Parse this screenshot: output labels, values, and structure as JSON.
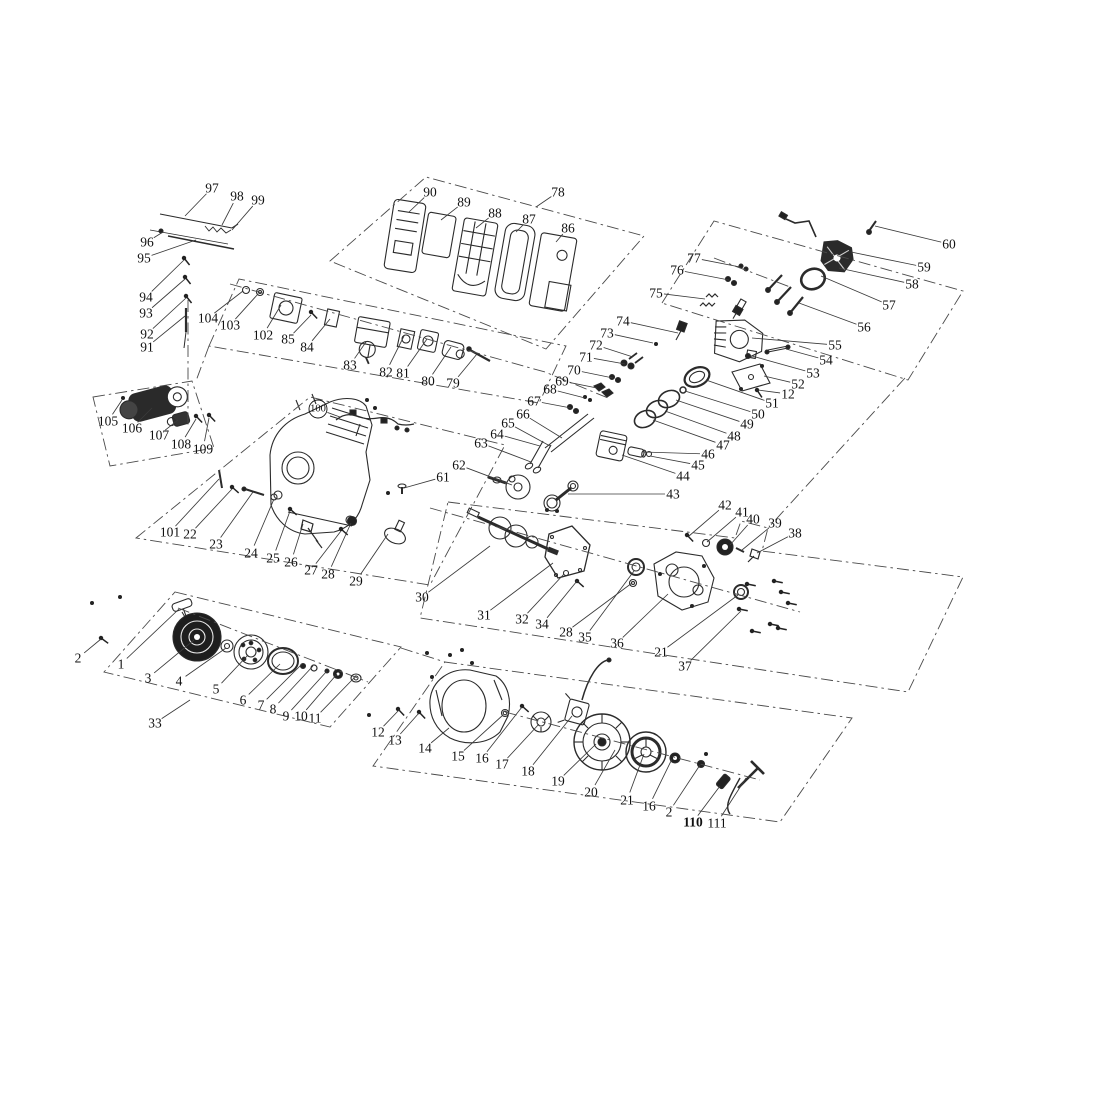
{
  "doc": {
    "kind": "engine exploded parts diagram",
    "page_background": "#ffffff"
  },
  "canvas": {
    "w": 1119,
    "h": 1119,
    "bg": "#ffffff",
    "ink": "#2b2b2b",
    "phantom_color": "#4a4a4a",
    "leader_color": "#3a3a3a",
    "label_color": "#111111",
    "label_font_size": 13.5
  },
  "callouts": [
    {
      "n": "97",
      "x": 212,
      "y": 188,
      "tx": 185,
      "ty": 216
    },
    {
      "n": "98",
      "x": 237,
      "y": 196,
      "tx": 222,
      "ty": 225
    },
    {
      "n": "99",
      "x": 258,
      "y": 200,
      "tx": 232,
      "ty": 230
    },
    {
      "n": "96",
      "x": 147,
      "y": 242,
      "tx": 163,
      "ty": 232
    },
    {
      "n": "95",
      "x": 144,
      "y": 258,
      "tx": 196,
      "ty": 240
    },
    {
      "n": "94",
      "x": 146,
      "y": 297,
      "tx": 184,
      "ty": 260
    },
    {
      "n": "93",
      "x": 146,
      "y": 313,
      "tx": 185,
      "ty": 279
    },
    {
      "n": "92",
      "x": 147,
      "y": 334,
      "tx": 186,
      "ty": 298
    },
    {
      "n": "91",
      "x": 147,
      "y": 347,
      "tx": 185,
      "ty": 316
    },
    {
      "n": "90",
      "x": 430,
      "y": 192,
      "tx": 409,
      "ty": 212
    },
    {
      "n": "89",
      "x": 464,
      "y": 202,
      "tx": 441,
      "ty": 220
    },
    {
      "n": "88",
      "x": 495,
      "y": 213,
      "tx": 476,
      "ty": 228
    },
    {
      "n": "87",
      "x": 529,
      "y": 219,
      "tx": 516,
      "ty": 232
    },
    {
      "n": "86",
      "x": 568,
      "y": 228,
      "tx": 556,
      "ty": 242
    },
    {
      "n": "78",
      "x": 558,
      "y": 192,
      "tx": 536,
      "ty": 207
    },
    {
      "n": "104",
      "x": 208,
      "y": 318,
      "tx": 243,
      "ty": 291
    },
    {
      "n": "103",
      "x": 230,
      "y": 325,
      "tx": 258,
      "ty": 294
    },
    {
      "n": "102",
      "x": 263,
      "y": 335,
      "tx": 281,
      "ty": 305
    },
    {
      "n": "85",
      "x": 288,
      "y": 339,
      "tx": 311,
      "ty": 315
    },
    {
      "n": "84",
      "x": 307,
      "y": 347,
      "tx": 330,
      "ty": 319
    },
    {
      "n": "83",
      "x": 350,
      "y": 365,
      "tx": 366,
      "ty": 342
    },
    {
      "n": "82",
      "x": 386,
      "y": 372,
      "tx": 404,
      "ty": 336
    },
    {
      "n": "81",
      "x": 403,
      "y": 373,
      "tx": 427,
      "ty": 339
    },
    {
      "n": "80",
      "x": 428,
      "y": 381,
      "tx": 451,
      "ty": 347
    },
    {
      "n": "79",
      "x": 453,
      "y": 383,
      "tx": 477,
      "ty": 354
    },
    {
      "n": "105",
      "x": 108,
      "y": 421,
      "tx": 122,
      "ty": 400
    },
    {
      "n": "106",
      "x": 132,
      "y": 428,
      "tx": 152,
      "ty": 408
    },
    {
      "n": "107",
      "x": 159,
      "y": 435,
      "tx": 178,
      "ty": 420
    },
    {
      "n": "108",
      "x": 181,
      "y": 444,
      "tx": 196,
      "ty": 419
    },
    {
      "n": "109",
      "x": 203,
      "y": 449,
      "tx": 209,
      "ty": 418
    },
    {
      "n": "100",
      "x": 318,
      "y": 409,
      "tx": 340,
      "ty": 417,
      "c": 1
    },
    {
      "n": "101",
      "x": 170,
      "y": 532,
      "tx": 219,
      "ty": 479
    },
    {
      "n": "22",
      "x": 190,
      "y": 534,
      "tx": 232,
      "ty": 489
    },
    {
      "n": "23",
      "x": 216,
      "y": 544,
      "tx": 253,
      "ty": 492
    },
    {
      "n": "24",
      "x": 251,
      "y": 553,
      "tx": 274,
      "ty": 499
    },
    {
      "n": "25",
      "x": 273,
      "y": 558,
      "tx": 290,
      "ty": 511
    },
    {
      "n": "26",
      "x": 291,
      "y": 562,
      "tx": 303,
      "ty": 524
    },
    {
      "n": "27",
      "x": 311,
      "y": 570,
      "tx": 341,
      "ty": 531
    },
    {
      "n": "28",
      "x": 328,
      "y": 574,
      "tx": 351,
      "ty": 523
    },
    {
      "n": "29",
      "x": 356,
      "y": 581,
      "tx": 388,
      "ty": 534
    },
    {
      "n": "61",
      "x": 443,
      "y": 477,
      "tx": 404,
      "ty": 488
    },
    {
      "n": "62",
      "x": 459,
      "y": 465,
      "tx": 512,
      "ty": 485
    },
    {
      "n": "63",
      "x": 481,
      "y": 443,
      "tx": 531,
      "ty": 462
    },
    {
      "n": "64",
      "x": 497,
      "y": 434,
      "tx": 540,
      "ty": 446
    },
    {
      "n": "65",
      "x": 508,
      "y": 423,
      "tx": 550,
      "ty": 446
    },
    {
      "n": "66",
      "x": 523,
      "y": 414,
      "tx": 562,
      "ty": 438
    },
    {
      "n": "67",
      "x": 534,
      "y": 401,
      "tx": 571,
      "ty": 408
    },
    {
      "n": "68",
      "x": 550,
      "y": 389,
      "tx": 585,
      "ty": 398
    },
    {
      "n": "69",
      "x": 562,
      "y": 381,
      "tx": 597,
      "ty": 388
    },
    {
      "n": "70",
      "x": 574,
      "y": 370,
      "tx": 613,
      "ty": 378
    },
    {
      "n": "71",
      "x": 586,
      "y": 357,
      "tx": 625,
      "ty": 364
    },
    {
      "n": "72",
      "x": 596,
      "y": 345,
      "tx": 633,
      "ty": 357
    },
    {
      "n": "73",
      "x": 607,
      "y": 333,
      "tx": 653,
      "ty": 343
    },
    {
      "n": "74",
      "x": 623,
      "y": 321,
      "tx": 678,
      "ty": 333
    },
    {
      "n": "75",
      "x": 656,
      "y": 293,
      "tx": 705,
      "ty": 299
    },
    {
      "n": "76",
      "x": 677,
      "y": 270,
      "tx": 729,
      "ty": 280
    },
    {
      "n": "77",
      "x": 694,
      "y": 258,
      "tx": 740,
      "ty": 267
    },
    {
      "n": "60",
      "x": 949,
      "y": 244,
      "tx": 875,
      "ty": 226
    },
    {
      "n": "59",
      "x": 924,
      "y": 267,
      "tx": 851,
      "ty": 252
    },
    {
      "n": "58",
      "x": 912,
      "y": 284,
      "tx": 839,
      "ty": 268
    },
    {
      "n": "57",
      "x": 889,
      "y": 305,
      "tx": 821,
      "ty": 276
    },
    {
      "n": "56",
      "x": 864,
      "y": 327,
      "tx": 799,
      "ty": 303
    },
    {
      "n": "55",
      "x": 835,
      "y": 345,
      "tx": 752,
      "ty": 338
    },
    {
      "n": "54",
      "x": 826,
      "y": 360,
      "tx": 786,
      "ty": 349
    },
    {
      "n": "53",
      "x": 813,
      "y": 373,
      "tx": 752,
      "ty": 356
    },
    {
      "n": "52",
      "x": 798,
      "y": 384,
      "tx": 764,
      "ty": 376
    },
    {
      "n": "12",
      "x": 788,
      "y": 394,
      "tx": 758,
      "ty": 390
    },
    {
      "n": "51",
      "x": 772,
      "y": 403,
      "tx": 706,
      "ty": 380
    },
    {
      "n": "50",
      "x": 758,
      "y": 414,
      "tx": 685,
      "ty": 391
    },
    {
      "n": "49",
      "x": 747,
      "y": 424,
      "tx": 676,
      "ty": 400
    },
    {
      "n": "48",
      "x": 734,
      "y": 436,
      "tx": 665,
      "ty": 411
    },
    {
      "n": "47",
      "x": 723,
      "y": 445,
      "tx": 653,
      "ty": 420
    },
    {
      "n": "46",
      "x": 708,
      "y": 454,
      "tx": 643,
      "ty": 452
    },
    {
      "n": "45",
      "x": 698,
      "y": 465,
      "tx": 650,
      "ty": 456
    },
    {
      "n": "44",
      "x": 683,
      "y": 476,
      "tx": 622,
      "ty": 455
    },
    {
      "n": "43",
      "x": 673,
      "y": 494,
      "tx": 568,
      "ty": 494
    },
    {
      "n": "42",
      "x": 725,
      "y": 505,
      "tx": 689,
      "ty": 536
    },
    {
      "n": "41",
      "x": 742,
      "y": 512,
      "tx": 707,
      "ty": 542
    },
    {
      "n": "40",
      "x": 753,
      "y": 519,
      "tx": 730,
      "ty": 545
    },
    {
      "n": "39",
      "x": 775,
      "y": 523,
      "tx": 742,
      "ty": 550
    },
    {
      "n": "38",
      "x": 795,
      "y": 533,
      "tx": 757,
      "ty": 553
    },
    {
      "n": "30",
      "x": 422,
      "y": 597,
      "tx": 490,
      "ty": 546
    },
    {
      "n": "31",
      "x": 484,
      "y": 615,
      "tx": 553,
      "ty": 563
    },
    {
      "n": "32",
      "x": 522,
      "y": 619,
      "tx": 564,
      "ty": 574
    },
    {
      "n": "34",
      "x": 542,
      "y": 624,
      "tx": 577,
      "ty": 581
    },
    {
      "n": "28",
      "x": 566,
      "y": 632,
      "tx": 632,
      "ty": 583
    },
    {
      "n": "35",
      "x": 585,
      "y": 637,
      "tx": 634,
      "ty": 571
    },
    {
      "n": "36",
      "x": 617,
      "y": 643,
      "tx": 668,
      "ty": 594
    },
    {
      "n": "21",
      "x": 661,
      "y": 652,
      "tx": 738,
      "ty": 595
    },
    {
      "n": "37",
      "x": 685,
      "y": 666,
      "tx": 741,
      "ty": 611
    },
    {
      "n": "2",
      "x": 78,
      "y": 658,
      "tx": 101,
      "ty": 639
    },
    {
      "n": "1",
      "x": 121,
      "y": 664,
      "tx": 179,
      "ty": 609
    },
    {
      "n": "3",
      "x": 148,
      "y": 678,
      "tx": 194,
      "ty": 640
    },
    {
      "n": "4",
      "x": 179,
      "y": 681,
      "tx": 226,
      "ty": 648
    },
    {
      "n": "5",
      "x": 216,
      "y": 689,
      "tx": 248,
      "ty": 655
    },
    {
      "n": "6",
      "x": 243,
      "y": 700,
      "tx": 280,
      "ty": 664
    },
    {
      "n": "7",
      "x": 261,
      "y": 705,
      "tx": 302,
      "ty": 664
    },
    {
      "n": "8",
      "x": 273,
      "y": 709,
      "tx": 313,
      "ty": 666
    },
    {
      "n": "9",
      "x": 286,
      "y": 716,
      "tx": 327,
      "ty": 671
    },
    {
      "n": "10",
      "x": 301,
      "y": 716,
      "tx": 337,
      "ty": 674
    },
    {
      "n": "11",
      "x": 315,
      "y": 718,
      "tx": 354,
      "ty": 678
    },
    {
      "n": "33",
      "x": 155,
      "y": 723,
      "tx": 190,
      "ty": 700
    },
    {
      "n": "12",
      "x": 378,
      "y": 732,
      "tx": 399,
      "ty": 710
    },
    {
      "n": "13",
      "x": 395,
      "y": 740,
      "tx": 419,
      "ty": 713
    },
    {
      "n": "14",
      "x": 425,
      "y": 748,
      "tx": 449,
      "ty": 728
    },
    {
      "n": "15",
      "x": 458,
      "y": 756,
      "tx": 503,
      "ty": 715
    },
    {
      "n": "16",
      "x": 482,
      "y": 758,
      "tx": 522,
      "ty": 707
    },
    {
      "n": "17",
      "x": 502,
      "y": 764,
      "tx": 539,
      "ty": 724
    },
    {
      "n": "18",
      "x": 528,
      "y": 771,
      "tx": 572,
      "ty": 716
    },
    {
      "n": "19",
      "x": 558,
      "y": 781,
      "tx": 596,
      "ty": 744
    },
    {
      "n": "20",
      "x": 591,
      "y": 792,
      "tx": 615,
      "ty": 750
    },
    {
      "n": "21",
      "x": 627,
      "y": 800,
      "tx": 644,
      "ty": 754
    },
    {
      "n": "16",
      "x": 649,
      "y": 806,
      "tx": 672,
      "ty": 759
    },
    {
      "n": "2",
      "x": 669,
      "y": 812,
      "tx": 700,
      "ty": 765
    },
    {
      "n": "110",
      "x": 693,
      "y": 822,
      "tx": 720,
      "ty": 786,
      "b": 1
    },
    {
      "n": "111",
      "x": 717,
      "y": 823,
      "tx": 746,
      "ty": 778
    }
  ],
  "boundaries": [
    {
      "name": "air-cleaner-group-box",
      "points": "330,261 426,177 644,236 546,349"
    },
    {
      "name": "carburetor-group-box",
      "points": "209,346 239,279 566,346 539,403"
    },
    {
      "name": "cylinder-head-group-box",
      "points": "662,303 714,221 963,291 908,380"
    },
    {
      "name": "starter-motor-group-box",
      "points": "93,397 192,381 214,448 110,466"
    },
    {
      "name": "crankcase-group-box",
      "points": "136,538 310,397 505,445 430,585"
    },
    {
      "name": "cover-group-box",
      "points": "448,502 735,538 741,521 768,528 762,551 963,577 908,692 420,618"
    },
    {
      "name": "recoil-starter-group-box",
      "points": "175,592 401,647 330,727 104,672"
    },
    {
      "name": "flywheel-group-box",
      "points": "445,662 852,718 780,822 373,766"
    }
  ],
  "axes": [
    {
      "name": "carburetor-axis",
      "points": "230,284 545,372 608,398"
    },
    {
      "name": "crankshaft-axis",
      "points": "430,508 800,612"
    },
    {
      "name": "flywheel-axis",
      "points": "505,712 760,780"
    },
    {
      "name": "recoil-axis",
      "points": "178,608 368,682"
    },
    {
      "name": "stud-axis",
      "points": "188,300 188,428"
    },
    {
      "name": "head-inner-line",
      "points": "714,258 790,287"
    },
    {
      "name": "connector-right",
      "points": "905,378 768,528"
    },
    {
      "name": "connector-left",
      "points": "209,346 196,381"
    },
    {
      "name": "connector-bottom",
      "points": "401,648 445,662"
    }
  ],
  "dots": [
    {
      "x": 92,
      "y": 603
    },
    {
      "x": 120,
      "y": 597
    },
    {
      "x": 123,
      "y": 398
    },
    {
      "x": 367,
      "y": 400
    },
    {
      "x": 375,
      "y": 408
    },
    {
      "x": 388,
      "y": 493
    },
    {
      "x": 427,
      "y": 653
    },
    {
      "x": 450,
      "y": 655
    },
    {
      "x": 462,
      "y": 650
    },
    {
      "x": 432,
      "y": 677
    },
    {
      "x": 472,
      "y": 663
    },
    {
      "x": 369,
      "y": 715
    },
    {
      "x": 656,
      "y": 344
    },
    {
      "x": 585,
      "y": 397
    },
    {
      "x": 590,
      "y": 400
    },
    {
      "x": 706,
      "y": 754
    }
  ]
}
